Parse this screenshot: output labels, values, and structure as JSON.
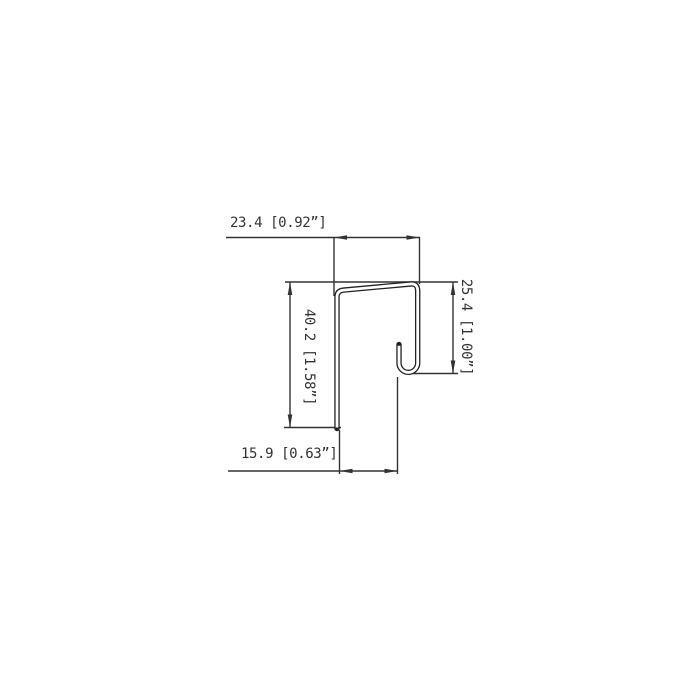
{
  "drawing": {
    "type": "technical-dimension-drawing",
    "subject": "sheet-metal J-profile cross-section",
    "colors": {
      "background": "#ffffff",
      "line": "#333333",
      "profile_line": "#222222",
      "text": "#333333"
    },
    "labels": {
      "top": "23.4 [0.92”]",
      "left": "40.2 [1.58”]",
      "right": "25.4 [1.00”]",
      "bottom": "15.9 [0.63”]"
    },
    "dimensions": [
      {
        "position": "top",
        "value_mm": 23.4,
        "value_in": "0.92”",
        "orientation": "horizontal"
      },
      {
        "position": "left",
        "value_mm": 40.2,
        "value_in": "1.58”",
        "orientation": "vertical"
      },
      {
        "position": "right",
        "value_mm": 25.4,
        "value_in": "1.00”",
        "orientation": "vertical"
      },
      {
        "position": "bottom",
        "value_mm": 15.9,
        "value_in": "0.63”",
        "orientation": "horizontal"
      }
    ]
  }
}
